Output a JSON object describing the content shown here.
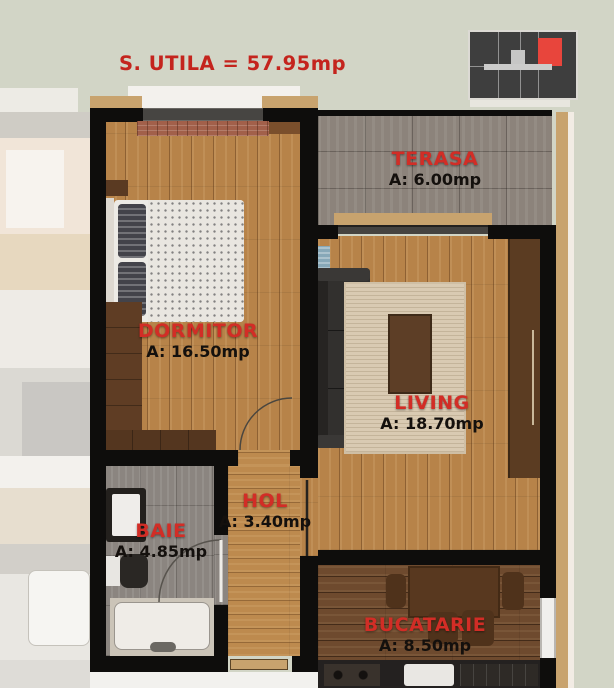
{
  "plan": {
    "title": "S. UTILA = 57.95mp",
    "rooms": [
      {
        "id": "terasa",
        "name": "TERASA",
        "area": "A: 6.00mp"
      },
      {
        "id": "dormitor",
        "name": "DORMITOR",
        "area": "A: 16.50mp"
      },
      {
        "id": "living",
        "name": "LIVING",
        "area": "A: 18.70mp"
      },
      {
        "id": "hol",
        "name": "HOL",
        "area": "A: 3.40mp"
      },
      {
        "id": "baie",
        "name": "BAIE",
        "area": "A: 4.85mp"
      },
      {
        "id": "bucatarie",
        "name": "BUCATARIE",
        "area": "A: 8.50mp"
      }
    ],
    "colors": {
      "accent_red": "#d22d26",
      "title_red": "#c4241d",
      "walls": "#0e0d0c",
      "background": "#d2d5c6",
      "wood_light": "#b78349",
      "wood_dark": "#6e4a2e",
      "tile_gray": "#8c837b",
      "logo_red": "#e8453c",
      "logo_body": "#3e3e3e"
    }
  }
}
